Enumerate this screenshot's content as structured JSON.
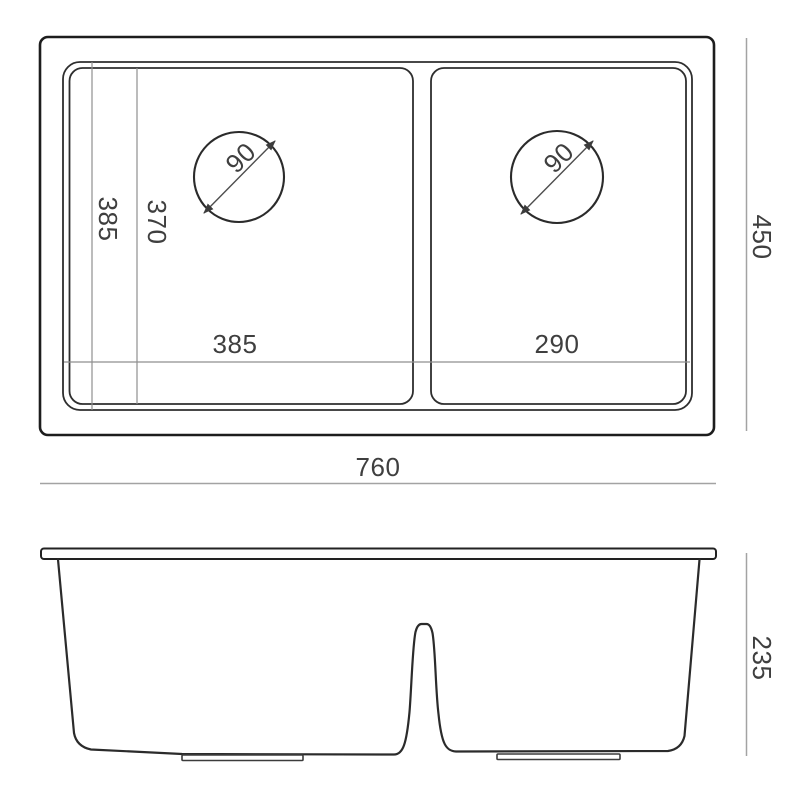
{
  "drawing": {
    "title": "Double bowl sink dimension drawing",
    "colors": {
      "line_dark": "#1d1d1d",
      "line_medium": "#2e2e2e",
      "dimension_line": "#a3a3a3",
      "text": "#3f3f3f",
      "background": "#ffffff"
    },
    "top_view": {
      "drain_left_diameter": "90",
      "drain_right_diameter": "90",
      "left_depth_outer": "385",
      "left_depth_inner": "370",
      "bowl_left_width": "385",
      "bowl_right_width": "290",
      "overall_depth": "450",
      "overall_width": "760"
    },
    "front_view": {
      "overall_height": "235"
    }
  }
}
